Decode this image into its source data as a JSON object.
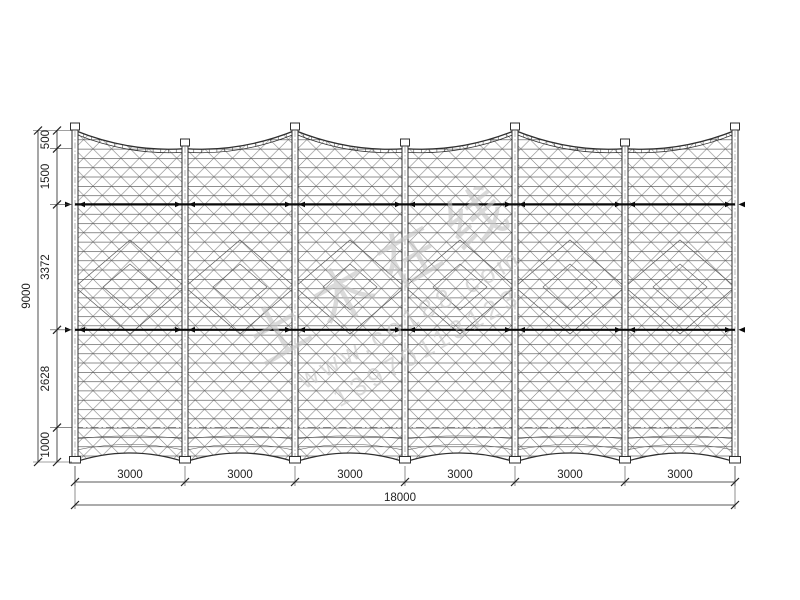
{
  "drawing": {
    "description": "Cable-net fence elevation drawing",
    "units": "mm",
    "total_height_label": "9000",
    "height_segments": [
      "500",
      "1500",
      "3372",
      "2628",
      "1000"
    ],
    "total_width_label": "18000",
    "width_segments": [
      "3000",
      "3000",
      "3000",
      "3000",
      "3000",
      "3000"
    ],
    "bay_count": 6,
    "post_count": 7
  },
  "watermark": {
    "line1": "土木在线",
    "line2": "www.co188.com",
    "line3": "13970113123"
  },
  "colors": {
    "line": "#2f2f2f",
    "mesh_h": "#4a4a4a",
    "mesh_d": "#6f6f6f",
    "detail": "#5a5a5a",
    "cable": "#0a0a0a",
    "dim": "#222222",
    "ext": "#444444",
    "dashed": "#555555",
    "post_center": "#808080",
    "watermark": "#c3c3c3",
    "background": "#ffffff"
  }
}
